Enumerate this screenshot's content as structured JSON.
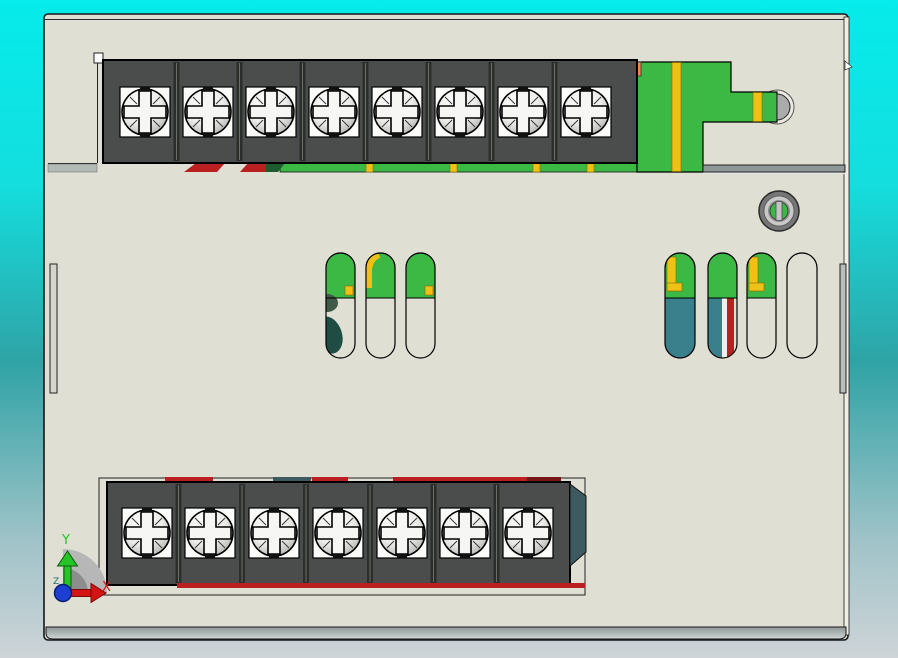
{
  "app": {
    "view_name": "cad-3d-viewport",
    "view_orientation": "top"
  },
  "triad": {
    "x_label": "X",
    "y_label": "Y",
    "z_label": "Z"
  },
  "colors": {
    "bg-top": "#06ebeb",
    "bg-upper": "#14dede",
    "bg-mid": "#2fa3a6",
    "bg-lower": "#9fc3c8",
    "bg-bottom": "#ced4d8",
    "body": "#e0dfd3",
    "body-edge": "#15171a",
    "block": "#4a4d4b",
    "divider": "#2c2e2c",
    "green": "#3cb845",
    "dkgreen": "#1e5c30",
    "olive": "#3f5a46",
    "yellow": "#eec117",
    "orange": "#ef8a4a",
    "red": "#bb2020",
    "maroon": "#7a1616",
    "teal": "#3a7f8c",
    "dkteal": "#1f4d44",
    "slate": "#3d5a60",
    "axis-x": "#d41414",
    "axis-y": "#27c427",
    "axis-z": "#1a6b6b",
    "origin-dot": "#1d3ed1"
  },
  "terminal_blocks": {
    "top": {
      "terminals": 8,
      "x": 103,
      "y": 60,
      "w": 534,
      "h": 103,
      "screw_y": 112,
      "screw_xs": [
        145,
        208,
        271,
        334,
        397,
        460,
        523,
        586
      ]
    },
    "bottom": {
      "terminals": 7,
      "x": 107,
      "y": 482,
      "w": 463,
      "h": 103,
      "screw_y": 533,
      "screw_xs": [
        147,
        210,
        274,
        338,
        402,
        465,
        528
      ]
    }
  },
  "pcb_slots": {
    "left_group_count": 3,
    "right_group_count": 4
  },
  "adjustment_hole": {
    "cx": 779,
    "cy": 211
  }
}
